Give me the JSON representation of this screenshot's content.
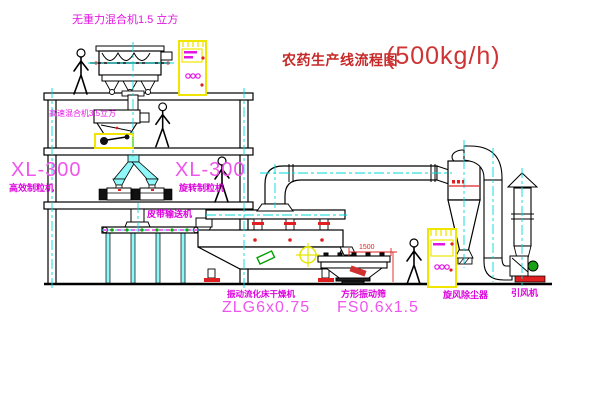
{
  "title": {
    "text": "农药生产线流程图",
    "capacity": "(500kg/h)"
  },
  "labels": {
    "gravity_mixer": "无重力混合机1.5 立方",
    "high_speed_mixer": "高速混合机3.5立方",
    "xl300_left_model": "XL-300",
    "xl300_left_name": "高效制粒机",
    "xl300_right_model": "XL-300",
    "xl300_right_name": "旋转制粒机",
    "belt_conveyor": "皮带输送机",
    "dryer_name": "振动流化床干燥机",
    "dryer_model": "ZLG6x0.75",
    "sieve_name": "方形振动筛",
    "sieve_model": "FS0.6x1.5",
    "cyclone": "旋风除尘器",
    "induced_draft_fan": "引风机"
  },
  "dimensions": {
    "sieve_length": "1500"
  },
  "colors": {
    "label_magenta": "#E315E3",
    "model_magenta": "#EE55EE",
    "title_red": "#C62828",
    "centerline_cyan": "#00DADA",
    "equipment_yellow": "#F0E500",
    "accent_red": "#E02020",
    "accent_green": "#00A000",
    "line_black": "#000000"
  }
}
